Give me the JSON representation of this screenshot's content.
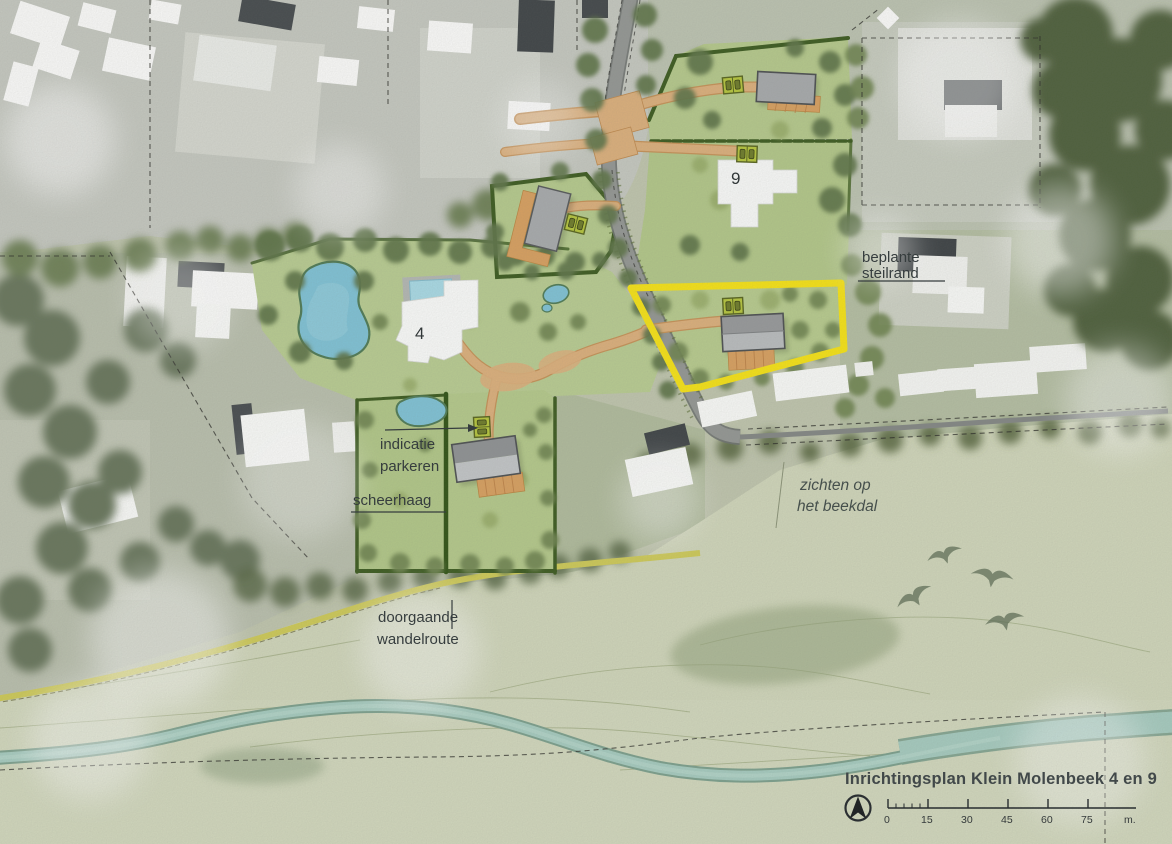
{
  "map": {
    "title": "Inrichtingsplan Klein Molenbeek 4 en 9",
    "parcel_labels": {
      "parcel_9": "9",
      "parcel_4": "4"
    },
    "annotations": {
      "steilrand_line1": "beplante",
      "steilrand_line2": "steilrand",
      "parkeren_line1": "indicatie",
      "parkeren_line2": "parkeren",
      "scheerhaag": "scheerhaag",
      "wandelroute_line1": "doorgaande",
      "wandelroute_line2": "wandelroute",
      "zichten_line1": "zichten op",
      "zichten_line2": "het beekdal"
    },
    "scale_bar": {
      "labels": [
        "0",
        "15",
        "30",
        "45",
        "60",
        "75"
      ],
      "unit": "m."
    },
    "icons": [
      "north-arrow-icon",
      "parking-icon",
      "bird-icon"
    ],
    "colors": {
      "highlight_parcel": "#f8e414",
      "hedge_green": "#3b5a1e",
      "path_orange": "#ddb07c",
      "deck_orange": "#d9a05f",
      "water_blue": "#7fc3d7",
      "stream_teal": "#a4cabf",
      "road_gray": "#949794",
      "parcel_green": "#b7cc8e",
      "parking_green": "#b6c63c",
      "title_color": "#3a4244"
    }
  }
}
